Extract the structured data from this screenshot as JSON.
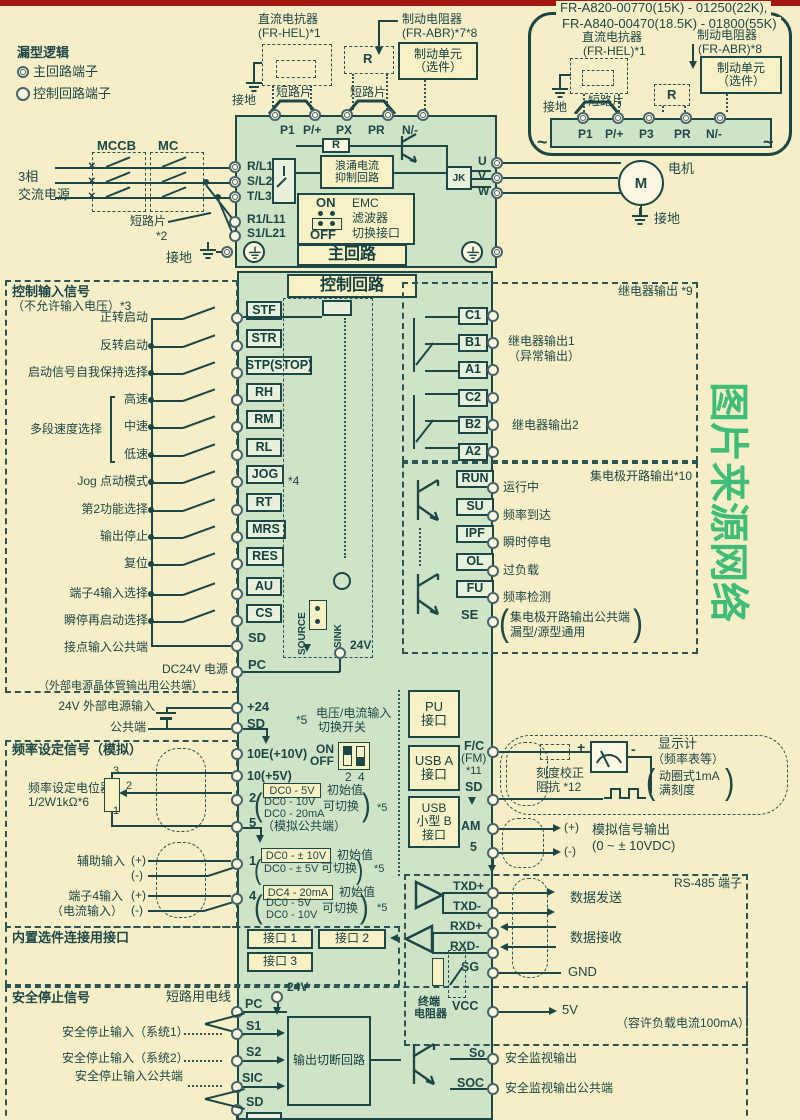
{
  "colors": {
    "background": "#f6eec6",
    "panel_green": "#cfe3c6",
    "ink": "#1d4747",
    "box_cream": "#f9f1c6",
    "terminal_fill": "#e7f0da",
    "top_bar_red": "#a2170f",
    "watermark_green": "#3fbd78"
  },
  "glyphs": {
    "open": "(",
    "close": ")",
    "times": "×",
    "wave": "~",
    "plus": "+",
    "minus": "-"
  },
  "legend": {
    "title": "漏型逻辑",
    "main": "主回路端子",
    "ctrl": "控制回路端子"
  },
  "topmid": {
    "reactor1": "直流电抗器",
    "reactor2": "(FR-HEL)*1",
    "ground": "接地",
    "jumper1": "短路片",
    "jumper2": "短路片",
    "brake1": "制动电阻器",
    "brake2": "(FR-ABR)*7*8",
    "r": "R",
    "unit1": "制动单元",
    "unit2": "（选件）",
    "t_p1": "P1",
    "t_pp": "P/+",
    "t_px": "PX",
    "t_pr": "PR",
    "t_nm": "N/-"
  },
  "inset": {
    "title1": "FR-A820-00770(15K) - 01250(22K),",
    "title2": "FR-A840-00470(18.5K) - 01800(55K)",
    "reactor1": "直流电抗器",
    "reactor2": "(FR-HEL)*1",
    "brake1": "制动电阻器",
    "brake2": "(FR-ABR)*8",
    "unit1": "制动单元",
    "unit2": "（选件）",
    "ground": "接地",
    "jumper": "短路片",
    "r": "R",
    "t_p1": "P1",
    "t_pp": "P/+",
    "t_p3": "P3",
    "t_pr": "PR",
    "t_nm": "N/-"
  },
  "power": {
    "phase1": "3相",
    "phase2": "交流电源",
    "mccb": "MCCB",
    "mc": "MC",
    "jumper": "短路片",
    "note": "*2",
    "ground": "接地",
    "rl1": "R/L1",
    "sl2": "S/L2",
    "tl3": "T/L3",
    "r1l11": "R1/L11",
    "s1l21": "S1/L21"
  },
  "mainc": {
    "r": "R",
    "surge1": "浪涌电流",
    "surge2": "抑制回路",
    "jk": "JK",
    "on": "ON",
    "off": "OFF",
    "emc1": "EMC",
    "emc2": "滤波器",
    "emc3": "切换接口",
    "title": "主回路",
    "u": "U",
    "v": "V",
    "w": "W",
    "m": "M",
    "motor": "电机",
    "ground": "接地"
  },
  "ctrl": {
    "header": "控制回路",
    "title": "控制输入信号",
    "sub": "（不允许输入电压）*3",
    "rows": [
      {
        "label": "正转启动",
        "term": "STF"
      },
      {
        "label": "反转启动",
        "term": "STR"
      },
      {
        "label": "启动信号自我保持选择",
        "term": "STP(STOP)"
      },
      {
        "label": "高速",
        "term": "RH"
      },
      {
        "label": "中速",
        "term": "RM"
      },
      {
        "label": "低速",
        "term": "RL"
      },
      {
        "label": "Jog 点动模式",
        "term": "JOG"
      },
      {
        "label": "第2功能选择",
        "term": "RT"
      },
      {
        "label": "输出停止",
        "term": "MRS"
      },
      {
        "label": "复位",
        "term": "RES"
      },
      {
        "label": "端子4输入选择",
        "term": "AU"
      },
      {
        "label": "瞬停再启动选择",
        "term": "CS"
      }
    ],
    "multi": "多段速度选择",
    "jog_note": "*4",
    "common": "接点输入公共端",
    "sd": "SD",
    "dc1": "DC24V 电源",
    "dc2": "（外部电源晶体管输出用公共端）",
    "pc": "PC",
    "source": "SOURCE",
    "sink": "SINK",
    "v24": "24V"
  },
  "ext": {
    "label": "24V 外部电源输入",
    "term": "+24",
    "common": "公共端",
    "sd": "SD"
  },
  "freq": {
    "title": "频率设定信号（模拟）",
    "te": "10E(+10V)",
    "t10": "10(+5V)",
    "pot1": "频率设定电位器",
    "pot2": "1/2W1kΩ*6",
    "pin3": "3",
    "pin2": "2",
    "pin1": "1",
    "t2": "2",
    "t5": "5",
    "t5note": "（模拟公共端）",
    "aux": "辅助输入",
    "plus": "(+)",
    "minus": "(-)",
    "t1": "1",
    "t4a": "端子4输入",
    "t4b": "（电流输入）",
    "t4": "4",
    "n5": "*5",
    "sw1": "电压/电流输入",
    "sw2": "切换开关",
    "on": "ON",
    "off": "OFF",
    "n2": "2",
    "n4": "4",
    "init": "初始值",
    "can": "可切换",
    "t2init": "DC0 - 5V",
    "t2alt1": "DC0 - 10V",
    "t2alt2": "DC0 - 20mA",
    "t1init": "DC0 - ± 10V",
    "t1alt": "DC0 - ± 5V",
    "t4init": "DC4 - 20mA",
    "t4alt1": "DC0 - 5V",
    "t4alt2": "DC0 - 10V"
  },
  "ports": {
    "pu1": "PU",
    "pu2": "接口",
    "ua1": "USB A",
    "ua2": "接口",
    "ub1": "USB",
    "ub2": "小型 B",
    "ub3": "接口"
  },
  "relay": {
    "header": "继电器输出 *9",
    "c1": "C1",
    "b1": "B1",
    "a1": "A1",
    "out1a": "继电器输出1",
    "out1b": "（异常输出）",
    "c2": "C2",
    "b2": "B2",
    "a2": "A2",
    "out2": "继电器输出2"
  },
  "oc": {
    "header": "集电极开路输出*10",
    "rows": [
      {
        "term": "RUN",
        "label": "运行中"
      },
      {
        "term": "SU",
        "label": "频率到达"
      },
      {
        "term": "IPF",
        "label": "瞬时停电"
      },
      {
        "term": "OL",
        "label": "过负载"
      },
      {
        "term": "FU",
        "label": "频率检测"
      }
    ],
    "se": "SE",
    "se1": "集电极开路输出公共端",
    "se2": "漏型/源型通用"
  },
  "fm": {
    "fc": "F/C",
    "fm": "(FM)",
    "n11": "*11",
    "sd": "SD",
    "cal1": "刻度校正",
    "cal2": "阻抗 *12",
    "disp1": "显示计",
    "disp2": "（频率表等）",
    "disp3": "动圈式1mA",
    "disp4": "满刻度"
  },
  "amo": {
    "am": "AM",
    "plus": "(+)",
    "minus": "(-)",
    "t5": "5",
    "l1": "模拟信号输出",
    "l2": "(0 ~ ± 10VDC)"
  },
  "rs": {
    "header": "RS-485 端子",
    "tp": "TXD+",
    "tm": "TXD-",
    "send": "数据发送",
    "rp": "RXD+",
    "rm": "RXD-",
    "recv": "数据接收",
    "sg": "SG",
    "gnd": "GND",
    "vcc": "VCC",
    "v5": "5V",
    "tr1": "终端",
    "tr2": "电阻器",
    "note": "（容许负载电流100mA）"
  },
  "opt": {
    "title": "内置选件连接用接口",
    "p1": "接口 1",
    "p2": "接口 2",
    "p3": "接口 3"
  },
  "sf": {
    "title": "安全停止信号",
    "wire": "短路用电线",
    "v24": "24V",
    "pc": "PC",
    "s1": "S1",
    "s2": "S2",
    "sic": "SIC",
    "sd": "SD",
    "in1": "安全停止输入（系统1）",
    "in2": "安全停止输入（系统2）",
    "inc": "安全停止输入公共端",
    "box": "输出切断回路",
    "so": "So",
    "soc": "SOC",
    "out": "安全监视输出",
    "outc": "安全监视输出公共端"
  },
  "wm": {
    "chars": [
      "图",
      "片",
      "来",
      "源",
      "网",
      "络"
    ]
  }
}
